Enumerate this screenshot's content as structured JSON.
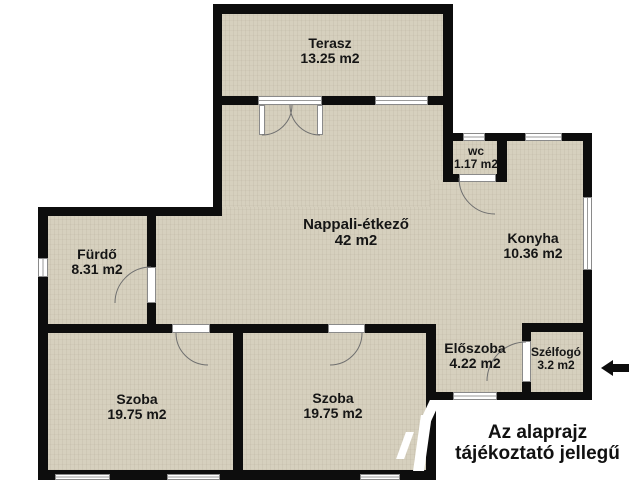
{
  "rooms": {
    "terasz": {
      "name": "Terasz",
      "area": "13.25 m2"
    },
    "nappali": {
      "name": "Nappali-étkező",
      "area": "42 m2"
    },
    "konyha": {
      "name": "Konyha",
      "area": "10.36 m2"
    },
    "wc": {
      "name": "wc",
      "area": "1.17 m2"
    },
    "furdo": {
      "name": "Fürdő",
      "area": "8.31 m2"
    },
    "szoba1": {
      "name": "Szoba",
      "area": "19.75 m2"
    },
    "szoba2": {
      "name": "Szoba",
      "area": "19.75 m2"
    },
    "eloszoba": {
      "name": "Előszoba",
      "area": "4.22 m2"
    },
    "szelfogo": {
      "name": "Szélfogó",
      "area": "3.2 m2"
    }
  },
  "disclaimer": {
    "line1": "Az alaprajz",
    "line2": "tájékoztató jellegű"
  },
  "colors": {
    "floor": "#d6d0be",
    "wall": "#0d0d0d",
    "frame": "#8a8a8a",
    "outside": "#ffffff"
  }
}
